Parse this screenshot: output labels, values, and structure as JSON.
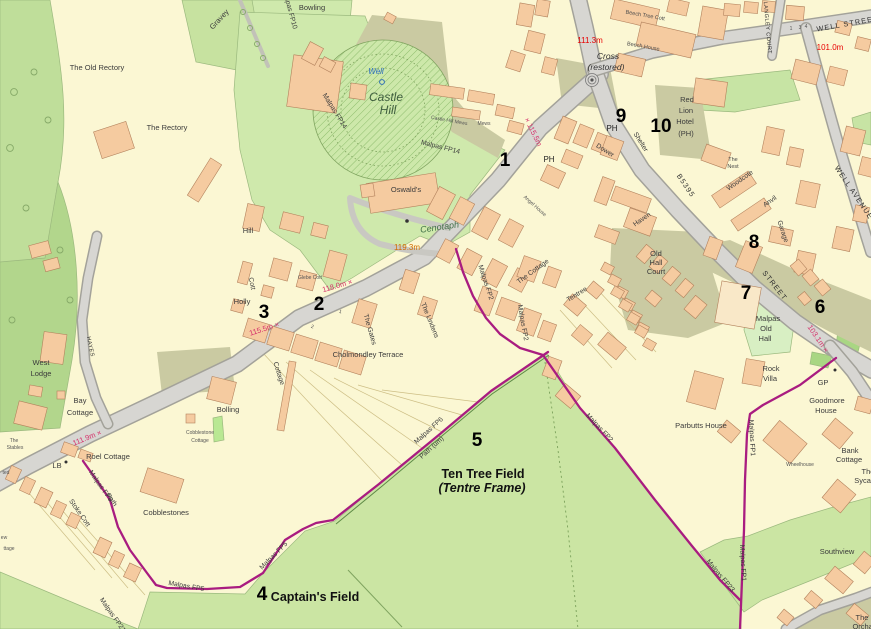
{
  "map": {
    "colors": {
      "parcel_cream": "#FBF7D3",
      "field_green": "#CBE5A3",
      "woodland_green": "#BFDE9A",
      "pale_green": "#D8EFC3",
      "bright_green": "#AFE18C",
      "road_gray": "#D7D6D2",
      "yard_khaki": "#CACAA2",
      "building_orange": "#F5CBA0",
      "footpath_magenta": "#A91C80",
      "spot_height_red": "#E80000",
      "spot_height_pink": "#D6336C"
    },
    "labels": [
      {
        "t": "The Old Rectory",
        "x": 97,
        "y": 70,
        "r": 0,
        "c": "place"
      },
      {
        "t": "The Rectory",
        "x": 167,
        "y": 130,
        "r": 0,
        "c": "place"
      },
      {
        "t": "Gravey",
        "x": 221,
        "y": 21,
        "r": -47,
        "c": "place"
      },
      {
        "t": "Bowling",
        "x": 312,
        "y": 10,
        "r": 0,
        "c": "place"
      },
      {
        "t": "Well",
        "x": 376,
        "y": 74,
        "r": 0,
        "c": "well"
      },
      {
        "t": "Castle",
        "x": 386,
        "y": 101,
        "r": 0,
        "c": "antiquity"
      },
      {
        "t": "Hill",
        "x": 388,
        "y": 114,
        "r": 0,
        "c": "antiquity"
      },
      {
        "t": "Oswald's",
        "x": 406,
        "y": 192,
        "r": 0,
        "c": "place"
      },
      {
        "t": "Cenotaph",
        "x": 440,
        "y": 230,
        "r": -8,
        "c": "cenotaph"
      },
      {
        "t": "119.3m",
        "x": 407,
        "y": 250,
        "r": 0,
        "c": "height-orange"
      },
      {
        "t": "111.3m",
        "x": 590,
        "y": 43,
        "r": 0,
        "c": "height-red"
      },
      {
        "t": "Cross",
        "x": 608,
        "y": 59,
        "r": 0,
        "c": "cross"
      },
      {
        "t": "(restored)",
        "x": 606,
        "y": 70,
        "r": 0,
        "c": "cross"
      },
      {
        "t": "Beech Tree Cott",
        "x": 645,
        "y": 17,
        "r": 10,
        "c": "tiny"
      },
      {
        "t": "Beech House",
        "x": 643,
        "y": 48,
        "r": 10,
        "c": "tiny"
      },
      {
        "t": "9",
        "x": 621,
        "y": 122,
        "r": 0,
        "c": "marker"
      },
      {
        "t": "PH",
        "x": 612,
        "y": 131,
        "r": 0,
        "c": "poi"
      },
      {
        "t": "10",
        "x": 661,
        "y": 132,
        "r": 0,
        "c": "marker"
      },
      {
        "t": "Red",
        "x": 687,
        "y": 102,
        "r": 0,
        "c": "place"
      },
      {
        "t": "Lion",
        "x": 686,
        "y": 113,
        "r": 0,
        "c": "place"
      },
      {
        "t": "Hotel",
        "x": 685,
        "y": 124,
        "r": 0,
        "c": "place"
      },
      {
        "t": "(PH)",
        "x": 686,
        "y": 136,
        "r": 0,
        "c": "place"
      },
      {
        "t": "Shelter",
        "x": 639,
        "y": 143,
        "r": 58,
        "c": "place-sm"
      },
      {
        "t": "Dower",
        "x": 604,
        "y": 152,
        "r": 32,
        "c": "place-sm"
      },
      {
        "t": "The",
        "x": 733,
        "y": 161,
        "r": 0,
        "c": "tiny"
      },
      {
        "t": "Nest",
        "x": 733,
        "y": 168,
        "r": 0,
        "c": "tiny"
      },
      {
        "t": "Woodcote",
        "x": 741,
        "y": 182,
        "r": -35,
        "c": "place-sm"
      },
      {
        "t": "Anvil",
        "x": 771,
        "y": 203,
        "r": -35,
        "c": "place-sm"
      },
      {
        "t": "Garage",
        "x": 781,
        "y": 232,
        "r": 72,
        "c": "place-sm"
      },
      {
        "t": "8",
        "x": 754,
        "y": 248,
        "r": 0,
        "c": "marker"
      },
      {
        "t": "WELL STREET",
        "x": 848,
        "y": 26,
        "r": -10,
        "c": "street"
      },
      {
        "t": "101.0m",
        "x": 830,
        "y": 50,
        "r": 0,
        "c": "height-red"
      },
      {
        "t": "LANGLEY COURT",
        "x": 766,
        "y": 28,
        "r": 85,
        "c": "street-sm"
      },
      {
        "t": "1",
        "x": 791,
        "y": 30,
        "r": 0,
        "c": "micro"
      },
      {
        "t": "3",
        "x": 800,
        "y": 29,
        "r": 0,
        "c": "micro"
      },
      {
        "t": "4",
        "x": 806,
        "y": 28,
        "r": 0,
        "c": "micro"
      },
      {
        "t": "WELL AVENUE",
        "x": 852,
        "y": 194,
        "r": 56,
        "c": "street"
      },
      {
        "t": "B5395",
        "x": 684,
        "y": 187,
        "r": 56,
        "c": "street"
      },
      {
        "t": "Haven",
        "x": 643,
        "y": 221,
        "r": -35,
        "c": "place-sm"
      },
      {
        "t": "Old",
        "x": 656,
        "y": 256,
        "r": 0,
        "c": "place"
      },
      {
        "t": "Hall",
        "x": 656,
        "y": 265,
        "r": 0,
        "c": "place"
      },
      {
        "t": "Court",
        "x": 656,
        "y": 274,
        "r": 0,
        "c": "place"
      },
      {
        "t": "7",
        "x": 746,
        "y": 299,
        "r": 0,
        "c": "marker"
      },
      {
        "t": "Malpas",
        "x": 768,
        "y": 321,
        "r": 0,
        "c": "place"
      },
      {
        "t": "Old",
        "x": 766,
        "y": 331,
        "r": 0,
        "c": "place"
      },
      {
        "t": "Hall",
        "x": 765,
        "y": 341,
        "r": 0,
        "c": "place"
      },
      {
        "t": "STREET",
        "x": 773,
        "y": 287,
        "r": 52,
        "c": "street"
      },
      {
        "t": "6",
        "x": 820,
        "y": 313,
        "r": 0,
        "c": "marker"
      },
      {
        "t": "103.1m ×",
        "x": 816,
        "y": 340,
        "r": 56,
        "c": "height-spot"
      },
      {
        "t": "GP",
        "x": 823,
        "y": 385,
        "r": 0,
        "c": "place"
      },
      {
        "t": "Rock",
        "x": 771,
        "y": 371,
        "r": 0,
        "c": "place"
      },
      {
        "t": "Villa",
        "x": 770,
        "y": 381,
        "r": 0,
        "c": "place"
      },
      {
        "t": "Goodmore",
        "x": 827,
        "y": 403,
        "r": 0,
        "c": "place"
      },
      {
        "t": "House",
        "x": 826,
        "y": 413,
        "r": 0,
        "c": "place"
      },
      {
        "t": "Bank",
        "x": 850,
        "y": 453,
        "r": 0,
        "c": "place"
      },
      {
        "t": "Cottage",
        "x": 849,
        "y": 462,
        "r": 0,
        "c": "place"
      },
      {
        "t": "The",
        "x": 868,
        "y": 474,
        "r": 0,
        "c": "place"
      },
      {
        "t": "Sycamores",
        "x": 873,
        "y": 483,
        "r": 0,
        "c": "place"
      },
      {
        "t": "Wheelhouse",
        "x": 800,
        "y": 466,
        "r": 0,
        "c": "micro"
      },
      {
        "t": "Parbutts House",
        "x": 701,
        "y": 428,
        "r": 0,
        "c": "place"
      },
      {
        "t": "Tentree",
        "x": 578,
        "y": 296,
        "r": -32,
        "c": "place-sm"
      },
      {
        "t": "Southview",
        "x": 837,
        "y": 554,
        "r": 0,
        "c": "place"
      },
      {
        "t": "The",
        "x": 862,
        "y": 620,
        "r": 0,
        "c": "place"
      },
      {
        "t": "Orchard",
        "x": 866,
        "y": 629,
        "r": 0,
        "c": "place"
      },
      {
        "t": "Malpas FP1",
        "x": 750,
        "y": 438,
        "r": 87,
        "c": "path"
      },
      {
        "t": "Malpas FP1",
        "x": 741,
        "y": 563,
        "r": 87,
        "c": "path"
      },
      {
        "t": "Malpas FP23",
        "x": 719,
        "y": 577,
        "r": 50,
        "c": "path"
      },
      {
        "t": "Malpas FP2",
        "x": 484,
        "y": 283,
        "r": 72,
        "c": "path"
      },
      {
        "t": "Malpas FP2",
        "x": 521,
        "y": 323,
        "r": 80,
        "c": "path"
      },
      {
        "t": "Malpas FP2",
        "x": 598,
        "y": 429,
        "r": 47,
        "c": "path"
      },
      {
        "t": "Malpas FP5",
        "x": 186,
        "y": 588,
        "r": 10,
        "c": "path"
      },
      {
        "t": "Malpas FP5",
        "x": 275,
        "y": 557,
        "r": -45,
        "c": "path"
      },
      {
        "t": "Malpas FP6",
        "x": 430,
        "y": 432,
        "r": -42,
        "c": "path"
      },
      {
        "t": "Path (um)",
        "x": 433,
        "y": 449,
        "r": -42,
        "c": "path"
      },
      {
        "t": "Malpas FP6",
        "x": 99,
        "y": 487,
        "r": 55,
        "c": "path"
      },
      {
        "t": "Path",
        "x": 110,
        "y": 501,
        "r": 55,
        "c": "path"
      },
      {
        "t": "Malpas FP21",
        "x": 111,
        "y": 616,
        "r": 55,
        "c": "path"
      },
      {
        "t": "Malpas FP14",
        "x": 333,
        "y": 112,
        "r": 58,
        "c": "path"
      },
      {
        "t": "Malpas FP14",
        "x": 440,
        "y": 149,
        "r": 14,
        "c": "path"
      },
      {
        "t": "Malpas FP10",
        "x": 288,
        "y": 10,
        "r": 75,
        "c": "path"
      },
      {
        "t": "Castle Hill Mews",
        "x": 449,
        "y": 122,
        "r": 10,
        "c": "micro"
      },
      {
        "t": "Mews",
        "x": 484,
        "y": 125,
        "r": 0,
        "c": "micro"
      },
      {
        "t": "1",
        "x": 505,
        "y": 166,
        "r": 0,
        "c": "marker"
      },
      {
        "t": "× 115.5m",
        "x": 531,
        "y": 133,
        "r": 64,
        "c": "height-spot"
      },
      {
        "t": "PH",
        "x": 549,
        "y": 162,
        "r": 0,
        "c": "poi"
      },
      {
        "t": "Angel House",
        "x": 534,
        "y": 207,
        "r": 42,
        "c": "micro"
      },
      {
        "t": "115.5m ×",
        "x": 265,
        "y": 331,
        "r": -18,
        "c": "height-spot"
      },
      {
        "t": "118.0m ×",
        "x": 338,
        "y": 288,
        "r": -16,
        "c": "height-spot"
      },
      {
        "t": "2",
        "x": 319,
        "y": 310,
        "r": 0,
        "c": "marker"
      },
      {
        "t": "3",
        "x": 264,
        "y": 318,
        "r": 0,
        "c": "marker"
      },
      {
        "t": "Glebe Cott",
        "x": 310,
        "y": 279,
        "r": 0,
        "c": "micro"
      },
      {
        "t": "Cott",
        "x": 250,
        "y": 284,
        "r": 78,
        "c": "place-sm"
      },
      {
        "t": "The Gates",
        "x": 368,
        "y": 330,
        "r": 74,
        "c": "place-sm"
      },
      {
        "t": "Cholmondley Terrace",
        "x": 368,
        "y": 357,
        "r": 0,
        "c": "place"
      },
      {
        "t": "The Lindens",
        "x": 428,
        "y": 321,
        "r": 68,
        "c": "place-sm"
      },
      {
        "t": "Cottage",
        "x": 277,
        "y": 374,
        "r": 72,
        "c": "place-sm"
      },
      {
        "t": "Hill",
        "x": 248,
        "y": 233,
        "r": 0,
        "c": "place"
      },
      {
        "t": "Holly",
        "x": 242,
        "y": 304,
        "r": 0,
        "c": "place"
      },
      {
        "t": "West",
        "x": 41,
        "y": 365,
        "r": 0,
        "c": "place"
      },
      {
        "t": "Lodge",
        "x": 41,
        "y": 376,
        "r": 0,
        "c": "place"
      },
      {
        "t": "Bay",
        "x": 80,
        "y": 403,
        "r": 0,
        "c": "place"
      },
      {
        "t": "Cottage",
        "x": 80,
        "y": 415,
        "r": 0,
        "c": "place"
      },
      {
        "t": "HAYES",
        "x": 89,
        "y": 347,
        "r": 78,
        "c": "street-sm"
      },
      {
        "t": "111.9m ×",
        "x": 88,
        "y": 440,
        "r": -22,
        "c": "height-spot"
      },
      {
        "t": "The",
        "x": 14,
        "y": 442,
        "r": 0,
        "c": "micro"
      },
      {
        "t": "Stables",
        "x": 15,
        "y": 449,
        "r": 0,
        "c": "micro"
      },
      {
        "t": "Roel Cottage",
        "x": 108,
        "y": 459,
        "r": 0,
        "c": "place"
      },
      {
        "t": "LB",
        "x": 57,
        "y": 468,
        "r": 0,
        "c": "place"
      },
      {
        "t": "Stoke Cott",
        "x": 78,
        "y": 514,
        "r": 55,
        "c": "place-sm"
      },
      {
        "t": "Cobblestones",
        "x": 166,
        "y": 515,
        "r": 0,
        "c": "place"
      },
      {
        "t": "Cobblestone",
        "x": 200,
        "y": 434,
        "r": 0,
        "c": "micro"
      },
      {
        "t": "Cottage",
        "x": 200,
        "y": 442,
        "r": 0,
        "c": "micro"
      },
      {
        "t": "Bolling",
        "x": 228,
        "y": 412,
        "r": 0,
        "c": "place"
      },
      {
        "t": "4",
        "x": 262,
        "y": 600,
        "r": 0,
        "c": "marker"
      },
      {
        "t": "Captain's Field",
        "x": 315,
        "y": 601,
        "r": 0,
        "c": "field-bold"
      },
      {
        "t": "5",
        "x": 477,
        "y": 446,
        "r": 0,
        "c": "marker"
      },
      {
        "t": "Ten Tree Field",
        "x": 483,
        "y": 478,
        "r": 0,
        "c": "field-bold"
      },
      {
        "t": "(Tentre Frame)",
        "x": 482,
        "y": 492,
        "r": 0,
        "c": "field-italic"
      },
      {
        "t": "The Cottage",
        "x": 534,
        "y": 273,
        "r": -36,
        "c": "place-sm"
      },
      {
        "t": "ted",
        "x": 6,
        "y": 474,
        "r": 0,
        "c": "micro"
      },
      {
        "t": "ew",
        "x": 4,
        "y": 539,
        "r": 0,
        "c": "micro"
      },
      {
        "t": "ttage",
        "x": 9,
        "y": 550,
        "r": 0,
        "c": "micro"
      },
      {
        "t": "1",
        "x": 340,
        "y": 313,
        "r": 17,
        "c": "micro"
      },
      {
        "t": "2",
        "x": 312,
        "y": 328,
        "r": 17,
        "c": "micro"
      }
    ]
  }
}
